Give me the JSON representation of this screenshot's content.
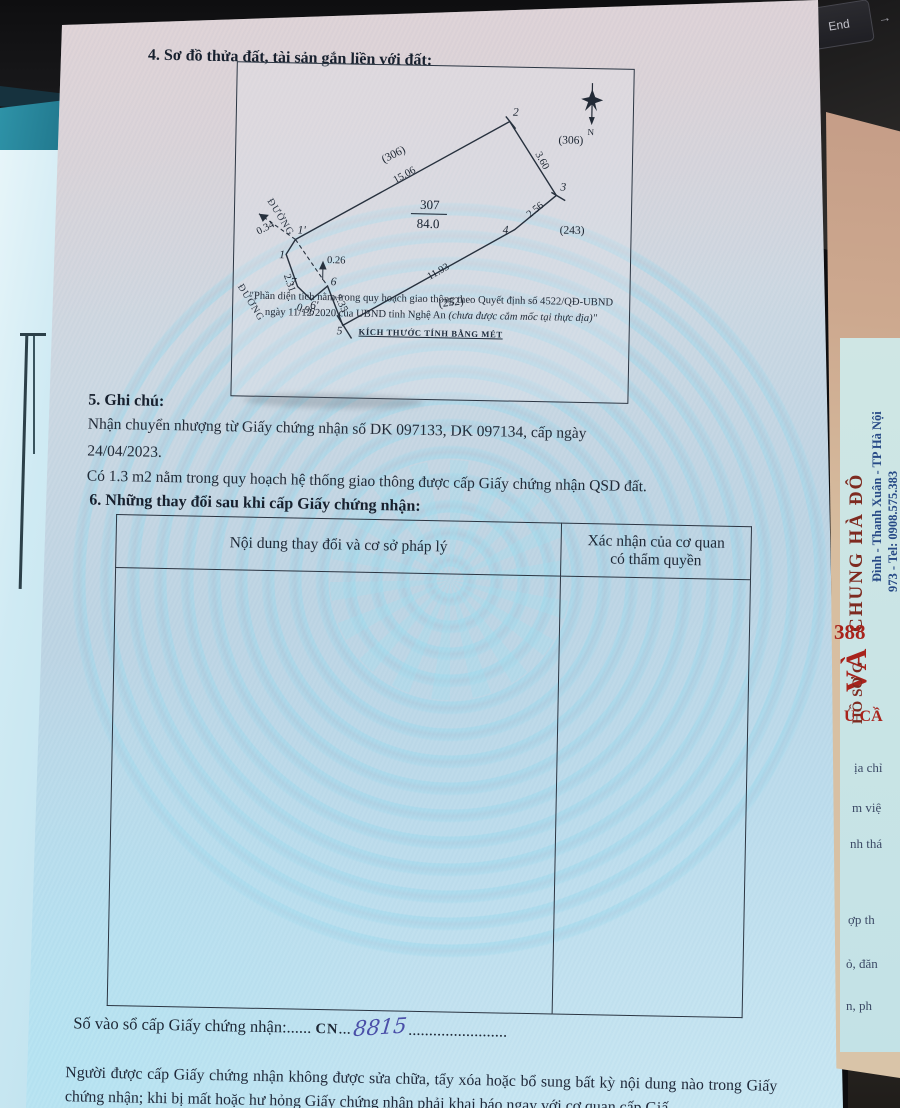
{
  "document": {
    "section4": {
      "title": "4. Sơ đồ thửa đất, tài sản gắn liền với đất:"
    },
    "diagram": {
      "plot_number": "307",
      "plot_area": "84.0",
      "north_label": "N",
      "road_label_upper": "ĐƯỜNG",
      "road_label_lower": "ĐƯỜNG",
      "vertices": {
        "v1": "1",
        "v1p": "1'",
        "v2": "2",
        "v3": "3",
        "v4": "4",
        "v5": "5",
        "v6": "6",
        "v6p": "6'",
        "v7": "7"
      },
      "dims": {
        "d_15_06": "15.06",
        "d_3_60": "3.60",
        "d_2_56": "2.56",
        "d_11_93": "11.93",
        "d_2_35": "2.35",
        "d_0_26": "0.26",
        "d_0_96": "0.96",
        "d_2_31": "2.31",
        "d_0_34": "0.34"
      },
      "neighbors": {
        "n_top": "(306)",
        "n_right": "(306)",
        "n_243": "(243)",
        "n_252": "(252)"
      },
      "note_line1": "\"Phần diện tích nằm trong quy hoạch giao thông theo Quyết định số 4522/QĐ-UBND",
      "note_line2a": "ngày 11/12/2020 của UBND tỉnh Nghệ An ",
      "note_line2b": "(chưa được cắm mốc tại thực địa)\"",
      "scale_note": "KÍCH THƯỚC TÍNH BẰNG MÉT"
    },
    "section5": {
      "title": "5. Ghi chú:",
      "line1": "Nhận chuyển nhượng từ Giấy chứng nhận số DK 097133, DK 097134, cấp ngày",
      "line2": "24/04/2023.",
      "line3": "Có 1.3 m2 nằm trong quy hoạch hệ thống giao thông được cấp Giấy chứng nhận QSD đất."
    },
    "section6": {
      "title": "6. Những thay đổi sau khi cấp Giấy chứng nhận:",
      "col1_header": "Nội dung thay đổi và cơ sở pháp lý",
      "col2_header_line1": "Xác nhận của cơ quan",
      "col2_header_line2": "có thẩm quyền"
    },
    "footer": {
      "serial_label": "Số vào sổ cấp Giấy chứng nhận:",
      "leader1": "......",
      "serial_prefix": "CN",
      "dots_mid": "...",
      "serial_number": "8815",
      "leader2": "........................",
      "notice": "Người được cấp Giấy chứng nhận không được sửa chữa, tẩy xóa hoặc bổ sung bất kỳ nội dung nào trong Giấy chứng nhận; khi bị mất hoặc hư hỏng Giấy chứng nhận phải khai báo ngay với cơ quan cấp Giấ"
    }
  },
  "surroundings": {
    "end_key": "End",
    "arrow_key": "→",
    "side_card": {
      "brand": "CHUNG HÀ ĐÔ",
      "red_large": "VÀ",
      "red_number": "388",
      "red_caps": "U CẦ",
      "folder_label": "HỒ SƠ G",
      "address": "Đình - Thanh Xuân - TP Hà Nội",
      "phone_line": "973  -  Tel: 0908.575.383",
      "web": "hadong.vn",
      "frag1": "ịa chỉ",
      "frag2": "m việ",
      "frag3": "nh thá",
      "frag4": "ợp th",
      "frag5": "ỏ, đăn",
      "frag6": "n, ph"
    }
  },
  "colors": {
    "paper_blue": "#bcdcec",
    "paper_pink": "#dcd6d9",
    "watermark_cyan": "#98d8ec",
    "ink": "#1e2630",
    "hand_ink": "#4a4fa8",
    "stamp_red": "#a8231c",
    "side_tan": "#cdA98f"
  }
}
